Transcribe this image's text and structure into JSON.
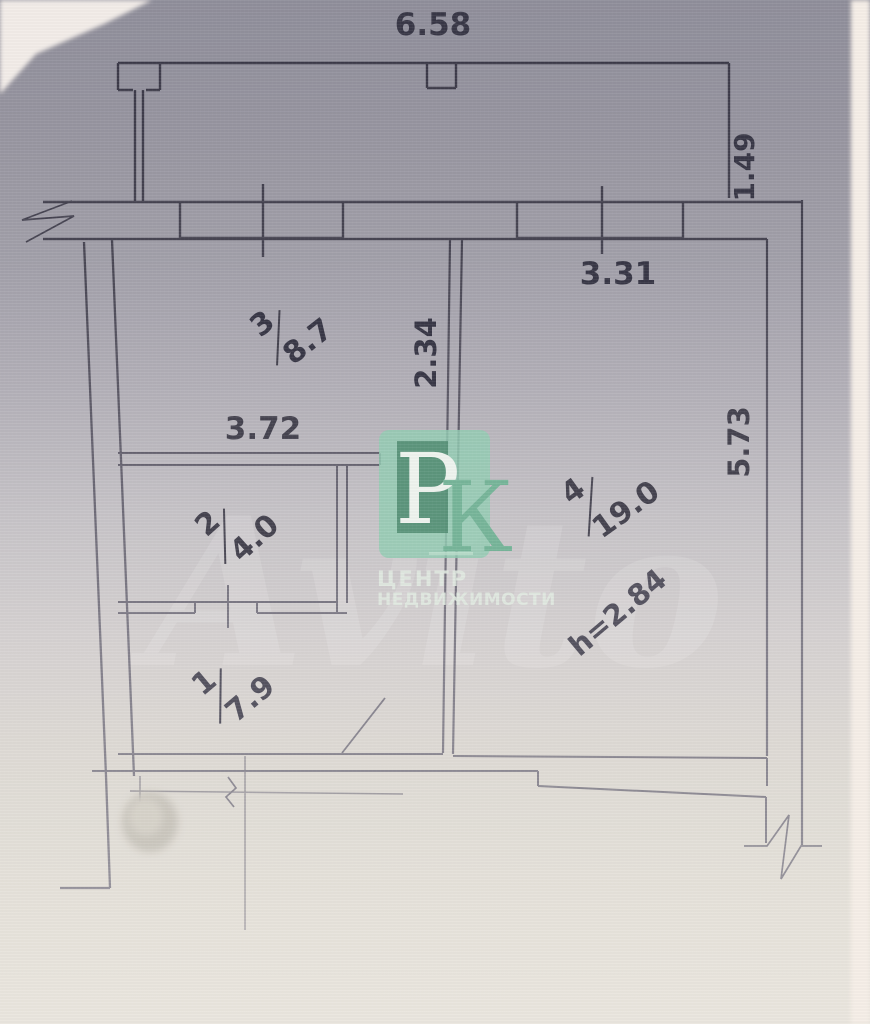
{
  "plan": {
    "dimensions": {
      "top_width": "6.58",
      "balcony_offset": "1.49",
      "room4_width": "3.31",
      "mid_vertical": "2.34",
      "room3_width": "3.72",
      "right_side": "5.73",
      "ceiling_height": "h=2.84"
    },
    "rooms": {
      "r1": {
        "num": "1",
        "area": "7.9"
      },
      "r2": {
        "num": "2",
        "area": "4.0"
      },
      "r3": {
        "num": "3",
        "area": "8.7"
      },
      "r4": {
        "num": "4",
        "area": "19.0"
      }
    }
  },
  "watermark": {
    "letter_p": "Р",
    "letter_k": "К",
    "line1": "ЦЕНТР",
    "line2": "НЕДВИЖИМОСТИ",
    "brand": "Avito",
    "colors": {
      "badge": "#93cdb3",
      "badge_inner": "#518c72",
      "letter_p": "#eef3ee",
      "letter_k": "#77b599",
      "caption": "#e2ebe2"
    }
  }
}
